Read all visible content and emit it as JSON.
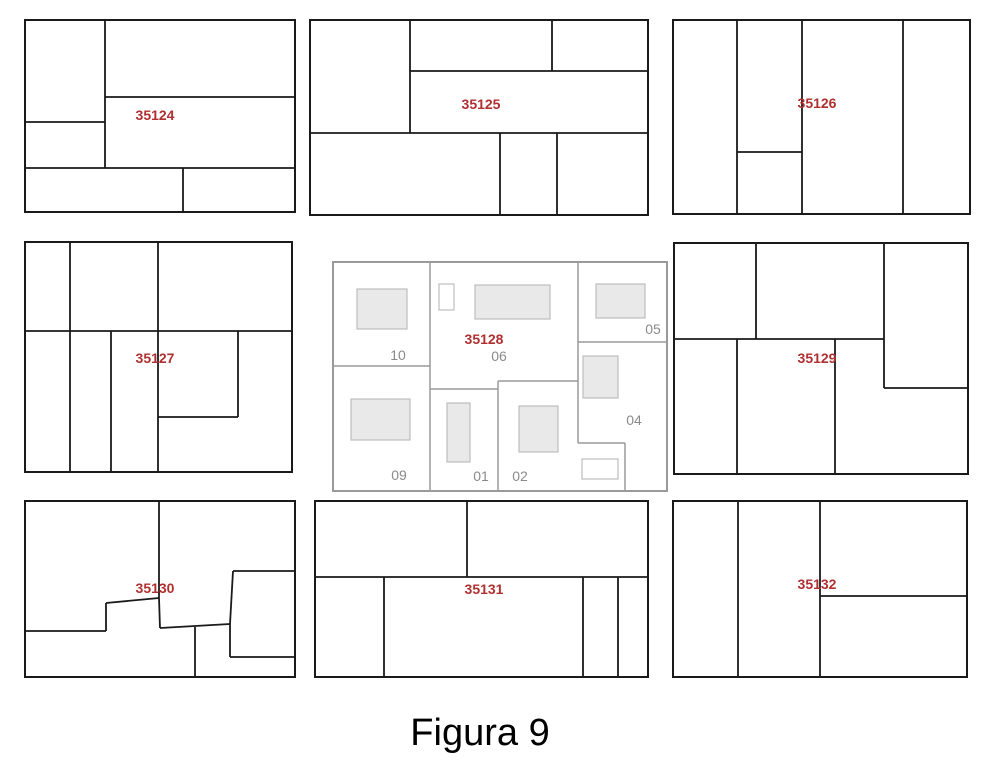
{
  "caption": "Figura 9",
  "colors": {
    "background": "#ffffff",
    "block_line": "#1a1a1a",
    "parcel_line": "#9a9a9a",
    "label_red": "#b03030",
    "label_gray": "#8a8a8a",
    "building_fill": "#e9e9e9",
    "building_empty_fill": "#ffffff",
    "building_stroke": "#bdbdbd",
    "caption_color": "#000000"
  },
  "blocks": [
    {
      "name": "block-35124",
      "label": "35124",
      "label_pos": [
        155,
        120
      ],
      "outline": [
        25,
        20,
        270,
        192
      ],
      "lines": [
        [
          105,
          20,
          105,
          168
        ],
        [
          25,
          122,
          105,
          122
        ],
        [
          105,
          97,
          295,
          97
        ],
        [
          25,
          168,
          295,
          168
        ],
        [
          183,
          168,
          183,
          212
        ]
      ]
    },
    {
      "name": "block-35125",
      "label": "35125",
      "label_pos": [
        481,
        109
      ],
      "outline": [
        310,
        20,
        338,
        195
      ],
      "lines": [
        [
          410,
          20,
          410,
          133
        ],
        [
          552,
          20,
          552,
          71
        ],
        [
          410,
          71,
          648,
          71
        ],
        [
          310,
          133,
          648,
          133
        ],
        [
          500,
          133,
          500,
          215
        ],
        [
          557,
          133,
          557,
          215
        ]
      ]
    },
    {
      "name": "block-35126",
      "label": "35126",
      "label_pos": [
        817,
        108
      ],
      "outline": [
        673,
        20,
        297,
        194
      ],
      "lines": [
        [
          737,
          20,
          737,
          214
        ],
        [
          802,
          20,
          802,
          214
        ],
        [
          903,
          20,
          903,
          214
        ],
        [
          737,
          152,
          802,
          152
        ]
      ]
    },
    {
      "name": "block-35127",
      "label": "35127",
      "label_pos": [
        155,
        363
      ],
      "outline": [
        25,
        242,
        267,
        230
      ],
      "lines": [
        [
          70,
          242,
          70,
          472
        ],
        [
          158,
          242,
          158,
          472
        ],
        [
          25,
          331,
          292,
          331
        ],
        [
          111,
          331,
          111,
          472
        ],
        [
          238,
          331,
          238,
          417
        ],
        [
          158,
          417,
          238,
          417
        ]
      ]
    },
    {
      "name": "block-35129",
      "label": "35129",
      "label_pos": [
        817,
        363
      ],
      "outline": [
        674,
        243,
        294,
        231
      ],
      "lines": [
        [
          756,
          243,
          756,
          339
        ],
        [
          884,
          243,
          884,
          388
        ],
        [
          884,
          388,
          968,
          388
        ],
        [
          674,
          339,
          884,
          339
        ],
        [
          737,
          339,
          737,
          474
        ],
        [
          835,
          339,
          835,
          474
        ]
      ]
    },
    {
      "name": "block-35130",
      "label": "35130",
      "label_pos": [
        155,
        593
      ],
      "outline": [
        25,
        501,
        270,
        176
      ],
      "lines": [
        [
          159,
          501,
          159,
          598
        ],
        [
          106,
          603,
          159,
          598
        ],
        [
          106,
          603,
          106,
          631
        ],
        [
          25,
          631,
          106,
          631
        ],
        [
          159,
          598,
          160,
          628
        ],
        [
          160,
          628,
          230,
          624
        ],
        [
          195,
          627,
          195,
          677
        ],
        [
          233,
          571,
          295,
          571
        ],
        [
          233,
          571,
          230,
          624
        ],
        [
          230,
          624,
          230,
          657
        ],
        [
          230,
          657,
          295,
          657
        ]
      ]
    },
    {
      "name": "block-35131",
      "label": "35131",
      "label_pos": [
        484,
        594
      ],
      "outline": [
        315,
        501,
        333,
        176
      ],
      "lines": [
        [
          315,
          577,
          648,
          577
        ],
        [
          467,
          501,
          467,
          577
        ],
        [
          384,
          577,
          384,
          677
        ],
        [
          583,
          577,
          583,
          677
        ],
        [
          618,
          577,
          618,
          677
        ]
      ]
    },
    {
      "name": "block-35132",
      "label": "35132",
      "label_pos": [
        817,
        589
      ],
      "outline": [
        673,
        501,
        294,
        176
      ],
      "lines": [
        [
          738,
          501,
          738,
          677
        ],
        [
          820,
          501,
          820,
          677
        ],
        [
          820,
          596,
          967,
          596
        ]
      ]
    }
  ],
  "detail_block": {
    "name": "block-35128",
    "label": "35128",
    "label_pos": [
      484,
      344
    ],
    "outline": [
      333,
      262,
      334,
      229
    ],
    "lines": [
      [
        430,
        262,
        430,
        491
      ],
      [
        333,
        366,
        430,
        366
      ],
      [
        430,
        389,
        498,
        389
      ],
      [
        498,
        381,
        578,
        381
      ],
      [
        498,
        381,
        498,
        491
      ],
      [
        578,
        262,
        578,
        443
      ],
      [
        578,
        342,
        667,
        342
      ],
      [
        578,
        443,
        625,
        443
      ],
      [
        625,
        443,
        625,
        491
      ]
    ],
    "buildings": [
      {
        "rect": [
          357,
          289,
          50,
          40
        ],
        "filled": true
      },
      {
        "rect": [
          439,
          284,
          15,
          26
        ],
        "filled": false
      },
      {
        "rect": [
          475,
          285,
          75,
          34
        ],
        "filled": true
      },
      {
        "rect": [
          596,
          284,
          49,
          34
        ],
        "filled": true
      },
      {
        "rect": [
          583,
          356,
          35,
          42
        ],
        "filled": true
      },
      {
        "rect": [
          351,
          399,
          59,
          41
        ],
        "filled": true
      },
      {
        "rect": [
          447,
          403,
          23,
          59
        ],
        "filled": true
      },
      {
        "rect": [
          519,
          406,
          39,
          46
        ],
        "filled": true
      },
      {
        "rect": [
          582,
          459,
          36,
          20
        ],
        "filled": false
      }
    ],
    "parcels": [
      {
        "number": "10",
        "pos": [
          398,
          360
        ]
      },
      {
        "number": "06",
        "pos": [
          499,
          361
        ]
      },
      {
        "number": "05",
        "pos": [
          653,
          334
        ]
      },
      {
        "number": "04",
        "pos": [
          634,
          425
        ]
      },
      {
        "number": "09",
        "pos": [
          399,
          480
        ]
      },
      {
        "number": "01",
        "pos": [
          481,
          481
        ]
      },
      {
        "number": "02",
        "pos": [
          520,
          481
        ]
      }
    ]
  }
}
